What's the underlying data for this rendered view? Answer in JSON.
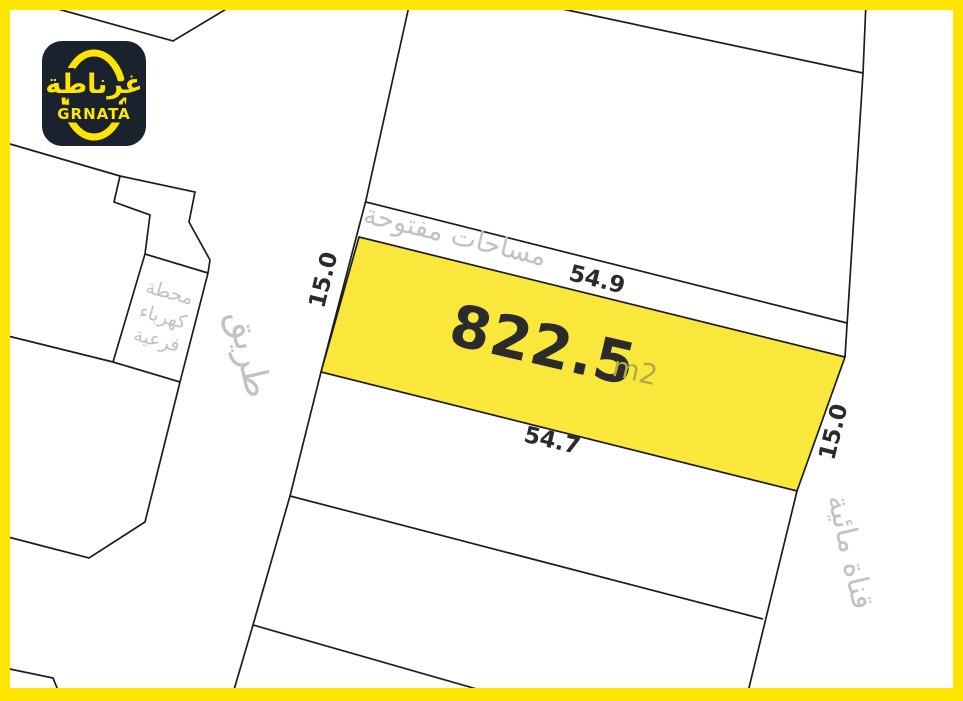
{
  "brand": {
    "logo_arabic": "غرناطة",
    "logo_latin": "GRNATA"
  },
  "plot": {
    "area": "822.5",
    "area_unit": "m2",
    "dim_top": "54.9",
    "dim_bottom": "54.7",
    "dim_left": "15.0",
    "dim_right": "15.0"
  },
  "labels": {
    "open_spaces": "مساحات مفتوحة",
    "road": "طريق",
    "substation_line1": "محطة",
    "substation_line2": "كهرباء",
    "substation_line3": "فرعية",
    "water_canal": "قناة مائية"
  },
  "colors": {
    "brand_yellow": "#FFE500",
    "plot_fill": "#F9E73C",
    "line_black": "#1D1D1D",
    "label_gray": "#C2C2C2",
    "dim_text": "#2B2B2B",
    "unit_olive": "#B2A945",
    "logo_bg": "#1A232D"
  }
}
